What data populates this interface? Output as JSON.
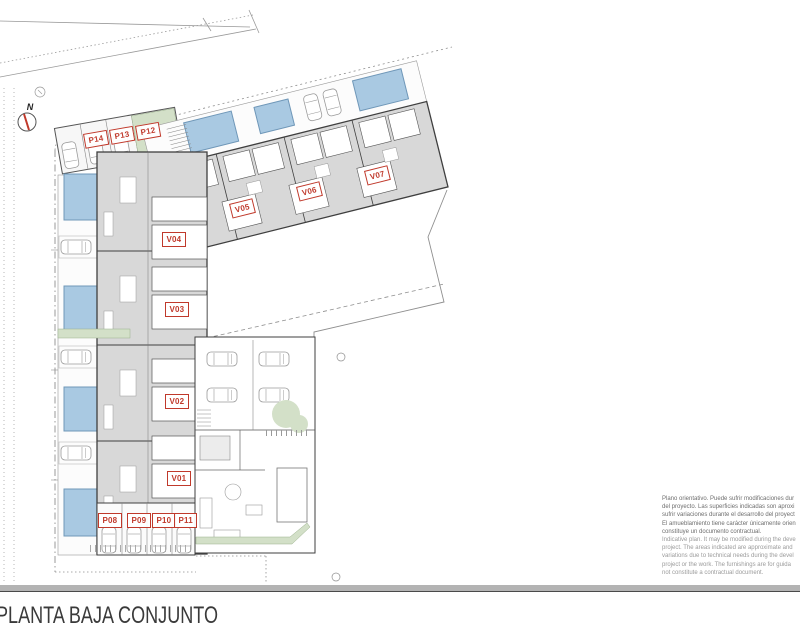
{
  "drawing": {
    "title": "PLANTA BAJA CONJUNTO",
    "north_label": "N",
    "unit_labels": [
      {
        "id": "V01"
      },
      {
        "id": "V02"
      },
      {
        "id": "V03"
      },
      {
        "id": "V04"
      },
      {
        "id": "V05"
      },
      {
        "id": "V06"
      },
      {
        "id": "V07"
      },
      {
        "id": "P08"
      },
      {
        "id": "P09"
      },
      {
        "id": "P10"
      },
      {
        "id": "P11"
      },
      {
        "id": "P12"
      },
      {
        "id": "P13"
      },
      {
        "id": "P14"
      }
    ],
    "colors": {
      "label_red": "#c0392b",
      "pool_blue": "#a9c9e2",
      "pool_border": "#6f97b8",
      "landscape_green": "#d3e0c8",
      "terrace_gray": "#d8d8d8",
      "wall_dark": "#3f3f3f",
      "road_gray": "#b3b3b3"
    },
    "disclaimer": {
      "es": [
        "Plano orientativo. Puede sufrir modificaciones dur",
        "del proyecto. Las superficies indicadas son aproxi",
        "sufrir variaciones durante el desarrollo del proyect",
        "El amueblamiento tiene carácter únicamente orien",
        "constituye un documento contractual."
      ],
      "en": [
        "Indicative plan. It may be modified during the deve",
        "project. The areas indicated are approximate and",
        "variations due to technical needs during the devel",
        "project or the work. The furnishings are for guida",
        "not constitute a contractual document."
      ]
    }
  }
}
